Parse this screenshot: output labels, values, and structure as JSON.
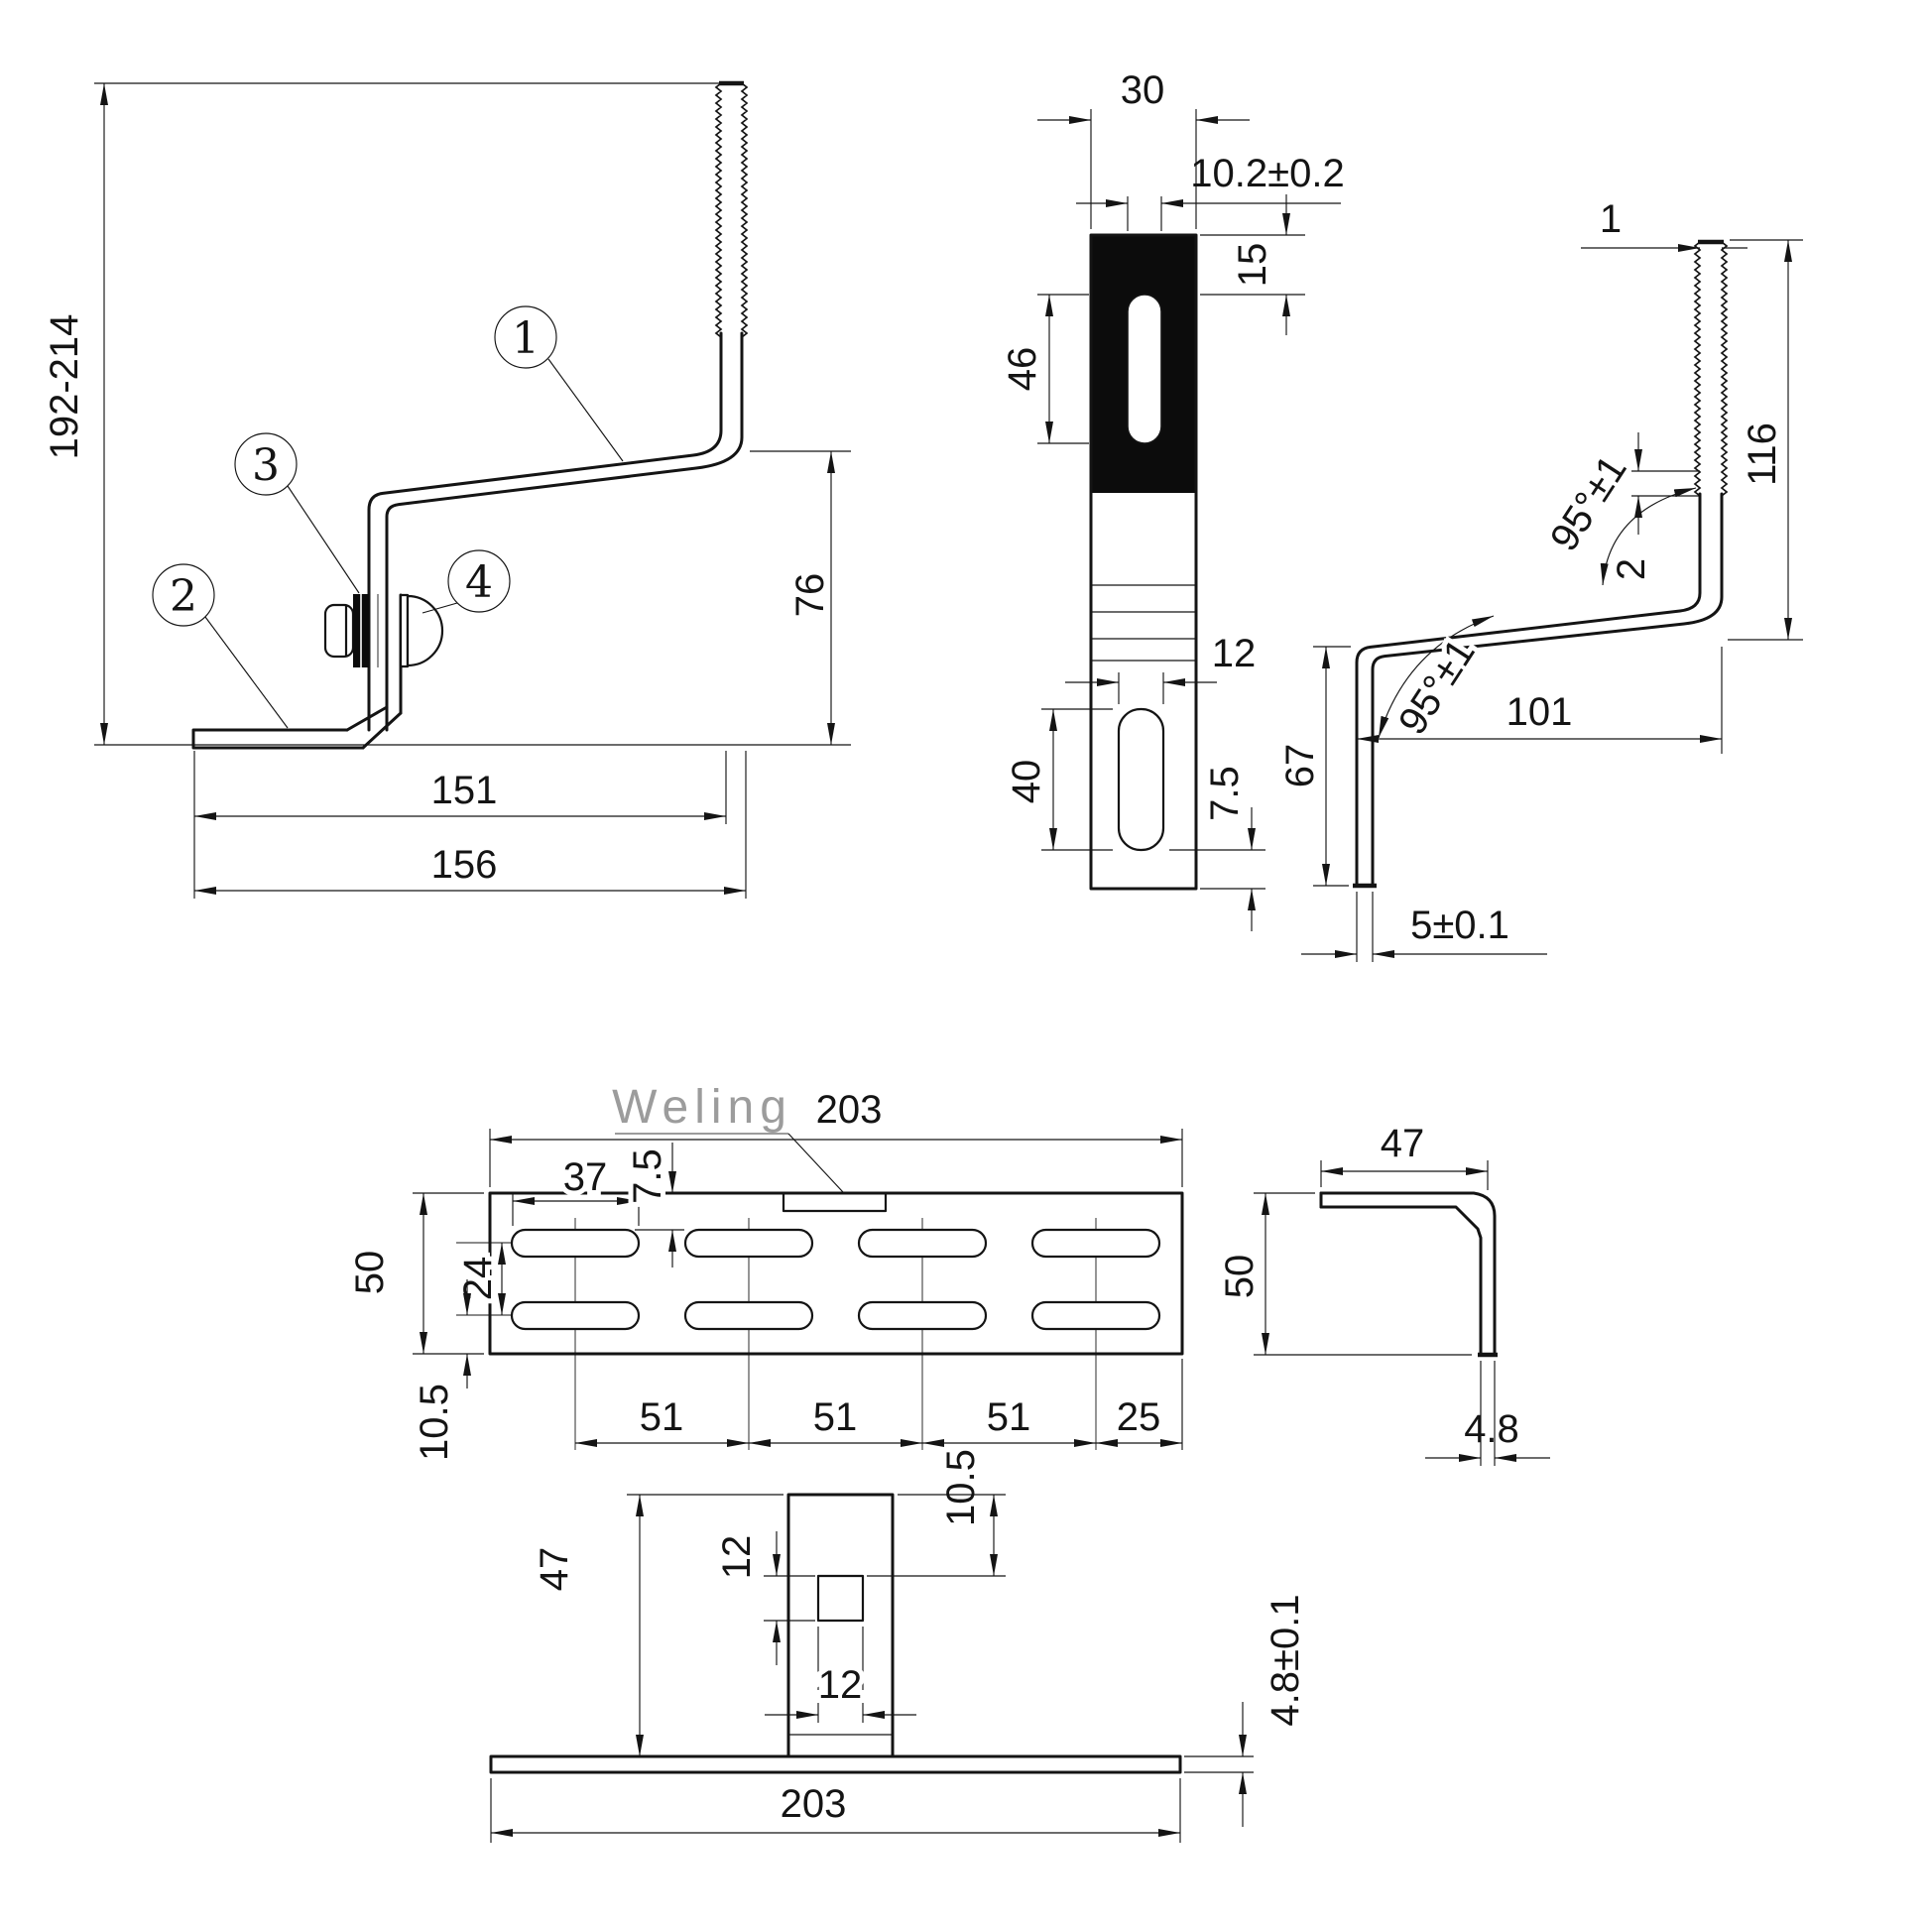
{
  "brand": "Weling",
  "assembly": {
    "overall_height": "192-214",
    "drop_height": "76",
    "length_to_rod": "151",
    "overall_length": "156",
    "callout_1": "1",
    "callout_2": "2",
    "callout_3": "3",
    "callout_4": "4"
  },
  "strap": {
    "width": "30",
    "slot_width": "10.2±0.2",
    "slot_top_offset": "15",
    "slot_length": "46",
    "lower_slot_width": "12",
    "lower_slot_length": "40",
    "lower_slot_bottom_margin": "7.5"
  },
  "hook": {
    "thread_crest": "1",
    "thread_pitch": "2",
    "rod_height": "116",
    "upper_angle": "95°±1",
    "lower_angle": "95°±1",
    "leg_height": "67",
    "arm_span": "101",
    "thickness": "5±0.1"
  },
  "plate_top": {
    "length": "203",
    "slot_length": "37",
    "slot_top_offset": "7.5",
    "width": "50",
    "row_spacing": "24",
    "bottom_offset": "10.5",
    "pitch_1": "51",
    "pitch_2": "51",
    "pitch_3": "51",
    "end_offset": "25"
  },
  "angle_profile": {
    "flange_width": "47",
    "height": "50",
    "thickness": "4.8"
  },
  "plate_front": {
    "tab_height": "47",
    "hole_height": "12",
    "hole_width": "12",
    "hole_top_offset": "10.5",
    "length": "203",
    "thickness": "4.8±0.1"
  }
}
